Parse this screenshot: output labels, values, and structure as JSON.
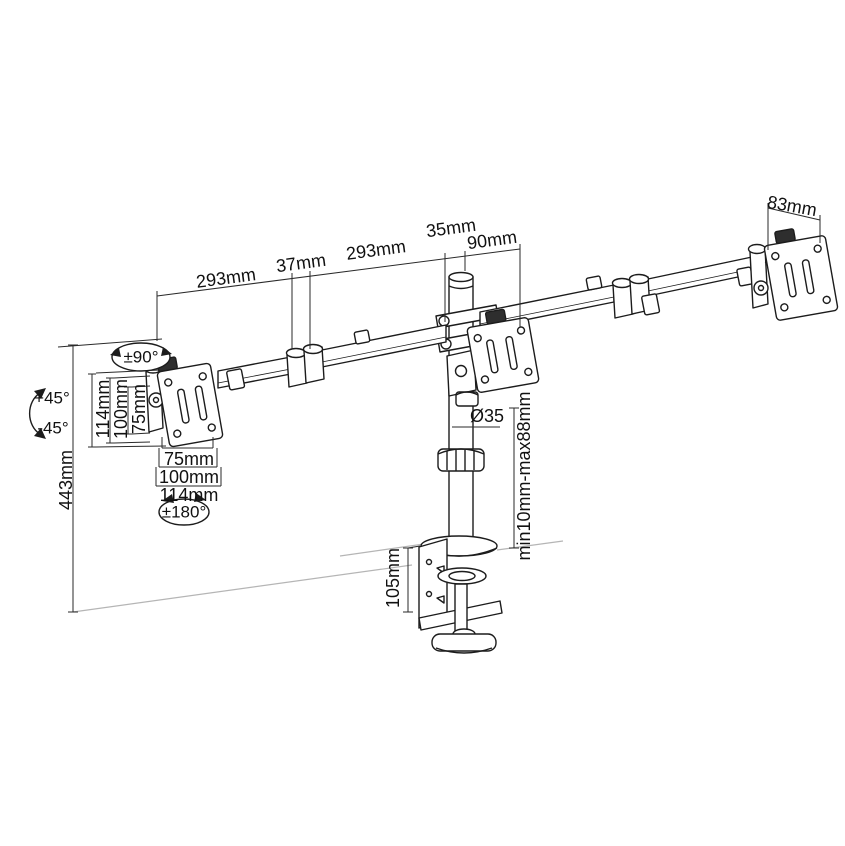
{
  "colors": {
    "background": "#ffffff",
    "part_line": "#1c1c1c",
    "dimension_line": "#2a2a2a",
    "desk_line": "#b5b5b5",
    "thumbscrew_fill": "#2e2e2e",
    "text": "#111111"
  },
  "dimensions": {
    "left_arm": "293mm",
    "elbow_gap": "37mm",
    "right_arm": "293mm",
    "pole_top": "35mm",
    "head_offset": "90mm",
    "right_plate": "83mm",
    "height": "443mm",
    "pole_diameter": "Ø35",
    "desk_thickness_range": "min10mm-max88mm",
    "clamp_height": "105mm",
    "vesa_vertical": [
      "114mm",
      "100mm",
      "75mm"
    ],
    "vesa_horizontal": [
      "75mm",
      "100mm",
      "114mm"
    ]
  },
  "rotations": {
    "swivel": "±90°",
    "tilt_up": "+45°",
    "tilt_down": "-45°",
    "rotate": "±180°"
  }
}
